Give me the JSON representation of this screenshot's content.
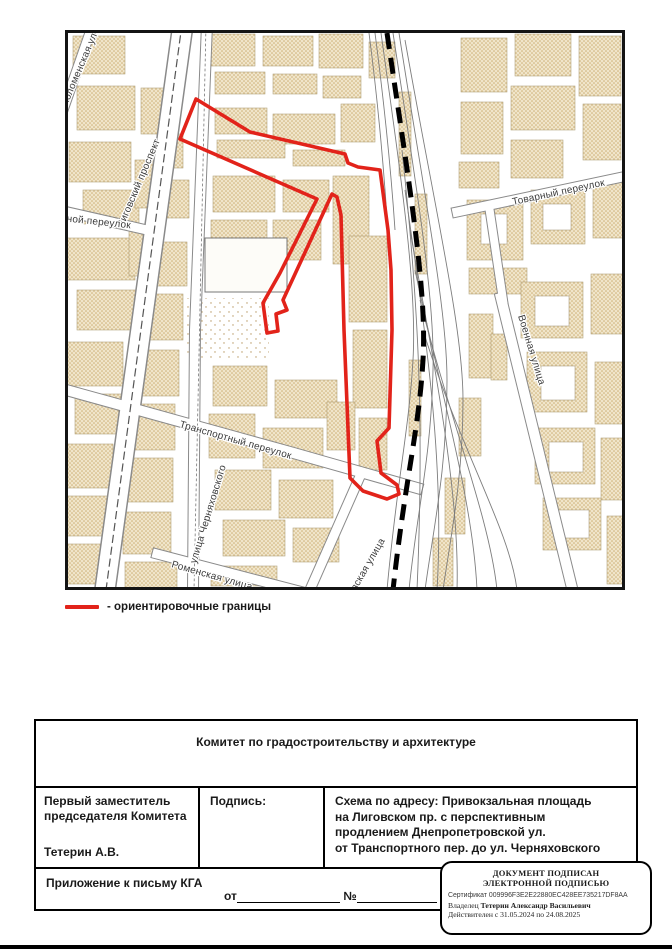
{
  "map": {
    "streets": [
      {
        "name": "Коломенская ул"
      },
      {
        "name": "Лиговский проспект"
      },
      {
        "name": "чной переулок"
      },
      {
        "name": "Товарный переулок"
      },
      {
        "name": "Военная улица"
      },
      {
        "name": "Транспортный переулок"
      },
      {
        "name": "улица Черняховского"
      },
      {
        "name": "Роменская улица"
      },
      {
        "name": "вская улица"
      }
    ],
    "boundary_color": "#e2231a"
  },
  "legend": {
    "label": "- ориентировочные границы"
  },
  "table": {
    "header": "Комитет по градостроительству и архитектуре",
    "official_title_line1": "Первый заместитель",
    "official_title_line2": "председателя Комитета",
    "official_name": "Тетерин А.В.",
    "signature_label": "Подпись:",
    "scheme_lines": [
      "Схема по адресу: Привокзальная площадь",
      "на Лиговском пр. с перспективным",
      "продлением Днепропетровской ул.",
      "от Транспортного пер. до ул. Черняховского"
    ],
    "attachment_label": "Приложение к письму КГА",
    "from_label": "от",
    "number_label": "№"
  },
  "stamp": {
    "title_line1": "ДОКУМЕНТ ПОДПИСАН",
    "title_line2": "ЭЛЕКТРОННОЙ ПОДПИСЬЮ",
    "certificate_line": "Сертификат 009996F3E2E22880EC428EE735217DF8AA",
    "owner_prefix": "Владелец",
    "owner_name": "Тетерин Александр Васильевич",
    "validity_line": "Действителен с 31.05.2024 по 24.08.2025"
  }
}
